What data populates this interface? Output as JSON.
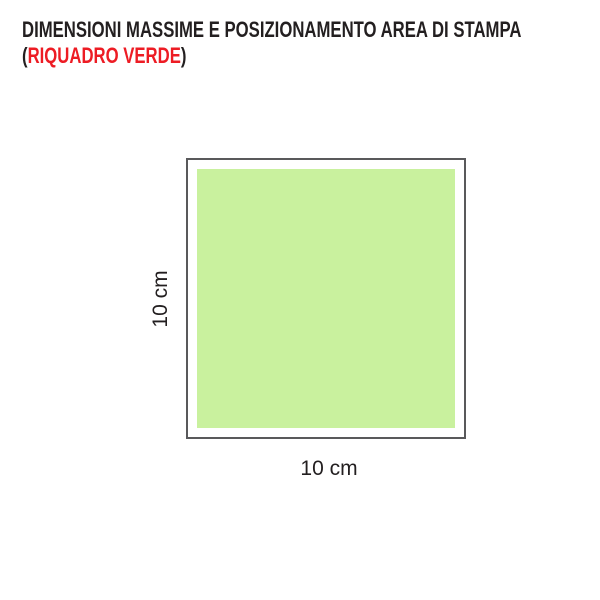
{
  "title": {
    "line1": "DIMENSIONI MASSIME E POSIZIONAMENTO AREA DI STAMPA",
    "line2_open": "(",
    "line2_highlight": "RIQUADRO VERDE",
    "line2_close": ")",
    "text_color": "#231f20",
    "highlight_color": "#ed1c24"
  },
  "diagram": {
    "outer_square": {
      "border_color": "#59595b",
      "fill": "#ffffff"
    },
    "print_area": {
      "fill": "#c9f19e"
    },
    "height_label": "10 cm",
    "width_label": "10 cm"
  }
}
